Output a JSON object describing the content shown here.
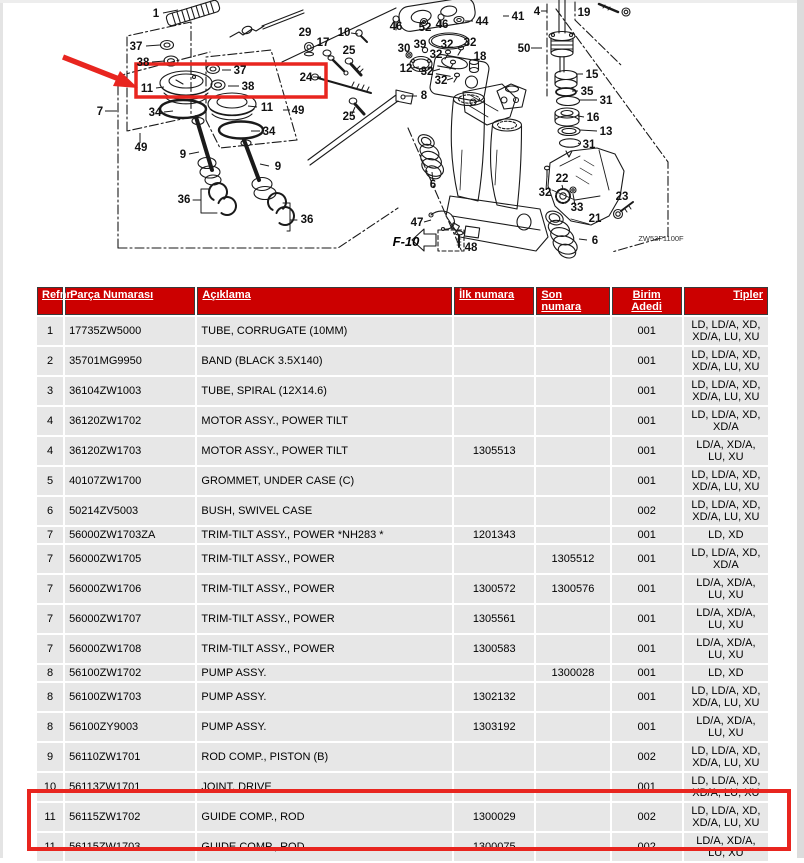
{
  "colors": {
    "header_bg": "#cc0000",
    "header_text": "#ffffff",
    "row_bg": "#e7e7e7",
    "highlight": "#e8251f",
    "line": "#1a1a1a"
  },
  "diagram": {
    "labels": [
      {
        "t": "1",
        "x": 156,
        "y": 17,
        "l": [
          163,
          13,
          178,
          10
        ]
      },
      {
        "t": "37",
        "x": 136,
        "y": 50,
        "l": [
          146,
          46,
          160,
          45
        ]
      },
      {
        "t": "38",
        "x": 143,
        "y": 66,
        "l": [
          152,
          62,
          165,
          61
        ]
      },
      {
        "t": "11",
        "x": 147,
        "y": 92,
        "l": [
          156,
          88,
          164,
          87
        ]
      },
      {
        "t": "7",
        "x": 100,
        "y": 115,
        "l": [
          105,
          111,
          117,
          111
        ]
      },
      {
        "t": "34",
        "x": 155,
        "y": 116,
        "l": [
          164,
          112,
          173,
          111
        ]
      },
      {
        "t": "49",
        "x": 141,
        "y": 151,
        "l": [
          140,
          143,
          140,
          133
        ]
      },
      {
        "t": "9",
        "x": 183,
        "y": 158,
        "l": [
          189,
          154,
          199,
          152
        ]
      },
      {
        "t": "36",
        "x": 184,
        "y": 203
      },
      {
        "t": "37",
        "x": 240,
        "y": 74,
        "l": [
          231,
          70,
          222,
          70
        ]
      },
      {
        "t": "38",
        "x": 248,
        "y": 90,
        "l": [
          239,
          86,
          228,
          86
        ]
      },
      {
        "t": "11",
        "x": 267,
        "y": 111,
        "l": [
          257,
          107,
          248,
          106
        ]
      },
      {
        "t": "49",
        "x": 298,
        "y": 114,
        "l": [
          290,
          110,
          283,
          110
        ]
      },
      {
        "t": "34",
        "x": 269,
        "y": 135,
        "l": [
          260,
          131,
          251,
          131
        ]
      },
      {
        "t": "9",
        "x": 278,
        "y": 170,
        "l": [
          269,
          166,
          260,
          164
        ]
      },
      {
        "t": "36",
        "x": 307,
        "y": 223
      },
      {
        "t": "29",
        "x": 305,
        "y": 36
      },
      {
        "t": "17",
        "x": 323,
        "y": 46
      },
      {
        "t": "10",
        "x": 344,
        "y": 36,
        "l": [
          351,
          33,
          358,
          34
        ]
      },
      {
        "t": "25",
        "x": 349,
        "y": 54
      },
      {
        "t": "24",
        "x": 306,
        "y": 81,
        "l": [
          313,
          77,
          321,
          77
        ]
      },
      {
        "t": "25",
        "x": 349,
        "y": 120,
        "l": [
          352,
          114,
          355,
          107
        ]
      },
      {
        "t": "46",
        "x": 396,
        "y": 30
      },
      {
        "t": "52",
        "x": 425,
        "y": 31
      },
      {
        "t": "46",
        "x": 442,
        "y": 28
      },
      {
        "t": "44",
        "x": 482,
        "y": 25,
        "l": [
          473,
          21,
          465,
          21
        ]
      },
      {
        "t": "41",
        "x": 518,
        "y": 20,
        "l": [
          509,
          16,
          503,
          16
        ]
      },
      {
        "t": "4",
        "x": 537,
        "y": 15,
        "l": [
          541,
          11,
          547,
          11
        ]
      },
      {
        "t": "19",
        "x": 584,
        "y": 16
      },
      {
        "t": "30",
        "x": 404,
        "y": 52
      },
      {
        "t": "39",
        "x": 420,
        "y": 48
      },
      {
        "t": "32",
        "x": 447,
        "y": 48
      },
      {
        "t": "32",
        "x": 470,
        "y": 46
      },
      {
        "t": "32",
        "x": 436,
        "y": 58
      },
      {
        "t": "18",
        "x": 480,
        "y": 60
      },
      {
        "t": "12",
        "x": 406,
        "y": 72,
        "l": [
          412,
          68,
          419,
          67
        ]
      },
      {
        "t": "32",
        "x": 427,
        "y": 75,
        "l": [
          433,
          71,
          440,
          69
        ]
      },
      {
        "t": "32",
        "x": 441,
        "y": 84,
        "l": [
          447,
          80,
          453,
          78
        ]
      },
      {
        "t": "8",
        "x": 424,
        "y": 99,
        "l": [
          417,
          96,
          405,
          96
        ]
      },
      {
        "t": "50",
        "x": 524,
        "y": 52,
        "l": [
          531,
          48,
          542,
          48
        ]
      },
      {
        "t": "15",
        "x": 592,
        "y": 78,
        "l": [
          583,
          74,
          576,
          74
        ]
      },
      {
        "t": "35",
        "x": 587,
        "y": 95,
        "l": [
          578,
          91,
          572,
          91
        ]
      },
      {
        "t": "31",
        "x": 606,
        "y": 104,
        "l": [
          597,
          100,
          579,
          100
        ]
      },
      {
        "t": "16",
        "x": 593,
        "y": 121,
        "l": [
          584,
          117,
          578,
          116
        ]
      },
      {
        "t": "13",
        "x": 606,
        "y": 135,
        "l": [
          597,
          131,
          580,
          130
        ]
      },
      {
        "t": "31",
        "x": 589,
        "y": 148,
        "l": [
          580,
          144,
          578,
          143
        ]
      },
      {
        "t": "22",
        "x": 562,
        "y": 182,
        "l": [
          562,
          185,
          563,
          189
        ]
      },
      {
        "t": "32",
        "x": 545,
        "y": 196,
        "l": [
          546,
          190,
          547,
          176
        ]
      },
      {
        "t": "33",
        "x": 577,
        "y": 211,
        "l": [
          575,
          205,
          573,
          194
        ]
      },
      {
        "t": "21",
        "x": 595,
        "y": 222
      },
      {
        "t": "23",
        "x": 622,
        "y": 200
      },
      {
        "t": "6",
        "x": 433,
        "y": 188,
        "l": [
          433,
          181,
          432,
          172
        ]
      },
      {
        "t": "6",
        "x": 595,
        "y": 244,
        "l": [
          587,
          240,
          579,
          239
        ]
      },
      {
        "t": "47",
        "x": 417,
        "y": 226,
        "l": [
          424,
          222,
          431,
          220
        ]
      },
      {
        "t": "48",
        "x": 471,
        "y": 251
      },
      {
        "t": "F-10",
        "x": 406,
        "y": 246,
        "cls": "pageRef"
      },
      {
        "t": "ZW53F1100F",
        "x": 661,
        "y": 241,
        "cls": "figCode"
      }
    ]
  },
  "table": {
    "headers": [
      "Refnr",
      "Parça Numarası",
      "Açıklama",
      "İlk numara",
      "Son numara",
      "Birim Adedi",
      "Tipler"
    ],
    "rows": [
      {
        "refnr": "1",
        "part_no": "17735ZW5000",
        "desc": "TUBE, CORRUGATE (10MM)",
        "ilk": "",
        "son": "",
        "birim": "001",
        "tipler": "LD, LD/A, XD, XD/A, LU, XU"
      },
      {
        "refnr": "2",
        "part_no": "35701MG9950",
        "desc": "BAND (BLACK 3.5X140)",
        "ilk": "",
        "son": "",
        "birim": "001",
        "tipler": "LD, LD/A, XD, XD/A, LU, XU"
      },
      {
        "refnr": "3",
        "part_no": "36104ZW1003",
        "desc": "TUBE, SPIRAL (12X14.6)",
        "ilk": "",
        "son": "",
        "birim": "001",
        "tipler": "LD, LD/A, XD, XD/A, LU, XU"
      },
      {
        "refnr": "4",
        "part_no": "36120ZW1702",
        "desc": "MOTOR ASSY., POWER TILT",
        "ilk": "",
        "son": "",
        "birim": "001",
        "tipler": "LD, LD/A, XD, XD/A"
      },
      {
        "refnr": "4",
        "part_no": "36120ZW1703",
        "desc": "MOTOR ASSY., POWER TILT",
        "ilk": "1305513",
        "son": "",
        "birim": "001",
        "tipler": "LD/A, XD/A, LU, XU"
      },
      {
        "refnr": "5",
        "part_no": "40107ZW1700",
        "desc": "GROMMET, UNDER CASE (C)",
        "ilk": "",
        "son": "",
        "birim": "001",
        "tipler": "LD, LD/A, XD, XD/A, LU, XU"
      },
      {
        "refnr": "6",
        "part_no": "50214ZV5003",
        "desc": "BUSH, SWIVEL CASE",
        "ilk": "",
        "son": "",
        "birim": "002",
        "tipler": "LD, LD/A, XD, XD/A, LU, XU"
      },
      {
        "refnr": "7",
        "part_no": "56000ZW1703ZA",
        "desc": "TRIM-TILT ASSY., POWER *NH283 *",
        "ilk": "1201343",
        "son": "",
        "birim": "001",
        "tipler": "LD, XD"
      },
      {
        "refnr": "7",
        "part_no": "56000ZW1705",
        "desc": "TRIM-TILT ASSY., POWER",
        "ilk": "",
        "son": "1305512",
        "birim": "001",
        "tipler": "LD, LD/A, XD, XD/A"
      },
      {
        "refnr": "7",
        "part_no": "56000ZW1706",
        "desc": "TRIM-TILT ASSY., POWER",
        "ilk": "1300572",
        "son": "1300576",
        "birim": "001",
        "tipler": "LD/A, XD/A, LU, XU"
      },
      {
        "refnr": "7",
        "part_no": "56000ZW1707",
        "desc": "TRIM-TILT ASSY., POWER",
        "ilk": "1305561",
        "son": "",
        "birim": "001",
        "tipler": "LD/A, XD/A, LU, XU"
      },
      {
        "refnr": "7",
        "part_no": "56000ZW1708",
        "desc": "TRIM-TILT ASSY., POWER",
        "ilk": "1300583",
        "son": "",
        "birim": "001",
        "tipler": "LD/A, XD/A, LU, XU"
      },
      {
        "refnr": "8",
        "part_no": "56100ZW1702",
        "desc": "PUMP ASSY.",
        "ilk": "",
        "son": "1300028",
        "birim": "001",
        "tipler": "LD, XD"
      },
      {
        "refnr": "8",
        "part_no": "56100ZW1703",
        "desc": "PUMP ASSY.",
        "ilk": "1302132",
        "son": "",
        "birim": "001",
        "tipler": "LD, LD/A, XD, XD/A, LU, XU"
      },
      {
        "refnr": "8",
        "part_no": "56100ZY9003",
        "desc": "PUMP ASSY.",
        "ilk": "1303192",
        "son": "",
        "birim": "001",
        "tipler": "LD/A, XD/A, LU, XU"
      },
      {
        "refnr": "9",
        "part_no": "56110ZW1701",
        "desc": "ROD COMP., PISTON (B)",
        "ilk": "",
        "son": "",
        "birim": "002",
        "tipler": "LD, LD/A, XD, XD/A, LU, XU"
      },
      {
        "refnr": "10",
        "part_no": "56113ZW1701",
        "desc": "JOINT, DRIVE",
        "ilk": "",
        "son": "",
        "birim": "001",
        "tipler": "LD, LD/A, XD, XD/A, LU, XU"
      },
      {
        "refnr": "11",
        "part_no": "56115ZW1702",
        "desc": "GUIDE COMP., ROD",
        "ilk": "1300029",
        "son": "",
        "birim": "002",
        "tipler": "LD, LD/A, XD, XD/A, LU, XU"
      },
      {
        "refnr": "11",
        "part_no": "56115ZW1703",
        "desc": "GUIDE COMP., ROD",
        "ilk": "1300075",
        "son": "",
        "birim": "002",
        "tipler": "LD/A, XD/A, LU, XU"
      }
    ]
  }
}
